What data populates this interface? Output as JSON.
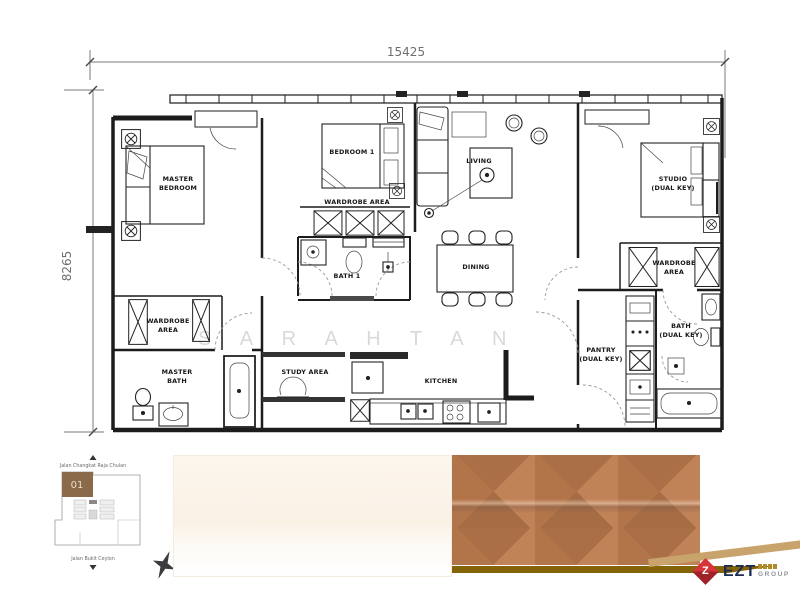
{
  "dimension_labels": {
    "width": "15425",
    "height": "8265"
  },
  "watermark_text": "S A R A H   T A N",
  "rooms": {
    "master_bedroom_l1": "MASTER",
    "master_bedroom_l2": "BEDROOM",
    "bedroom1": "BEDROOM 1",
    "wardrobe_mid": "WARDROBE AREA",
    "living": "LIVING",
    "studio_l1": "STUDIO",
    "studio_l2": "(DUAL KEY)",
    "dining": "DINING",
    "wardrobe_left_l1": "WARDROBE",
    "wardrobe_left_l2": "AREA",
    "master_bath_l1": "MASTER",
    "master_bath_l2": "BATH",
    "bath1": "BATH 1",
    "study_area": "STUDY AREA",
    "kitchen": "KITCHEN",
    "pantry_l1": "PANTRY",
    "pantry_l2": "(DUAL KEY)",
    "bath_dk_l1": "BATH",
    "bath_dk_l2": "(DUAL KEY)",
    "wardrobe_right_l1": "WARDROBE",
    "wardrobe_right_l2": "AREA"
  },
  "site_plan": {
    "street_top": "Jalan Changkat Raja Chulan",
    "street_bottom": "Jalan Bukit Ceylon",
    "unit": "01",
    "north": "N",
    "unit_color": "#8a6a49"
  },
  "materials": {
    "cream": "#fbf4ea",
    "copper": "#b5794e",
    "gold_band": "#846408",
    "tan_stripe": "#c8a36c"
  },
  "logo": {
    "brand": "EZT",
    "group": "GROUP",
    "icon_letter": "Z",
    "brand_color": "#1b2a52",
    "icon_color": "#c3272e"
  }
}
